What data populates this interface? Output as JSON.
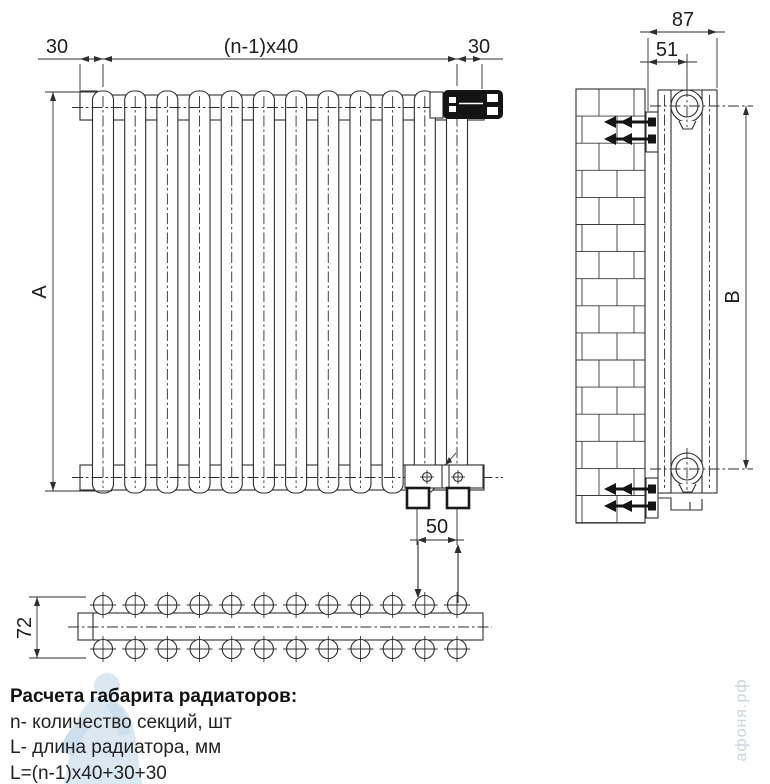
{
  "drawing": {
    "dimensions": {
      "margin_left": "30",
      "section_pitch": "(n-1)x40",
      "margin_right": "30",
      "height_total": "A",
      "bottom_connection_spacing": "50",
      "plan_depth": "72",
      "side_depth_total": "87",
      "side_pipe_offset": "51",
      "side_pipe_span": "B"
    },
    "section_count": 12,
    "plan_circle_rows": 2,
    "anchor_count": 4
  },
  "legend": {
    "title": "Расчета габарита радиаторов:",
    "line_sections": "n- количество секций, шт",
    "line_length": "L- длина радиатора, мм",
    "line_formula": "L=(n-1)x40+30+30"
  },
  "watermark": {
    "site": "афоня.рф"
  },
  "colors": {
    "line": "#2e2e2e",
    "fill_black": "#141414",
    "watermark_blue": "#bed7e8"
  }
}
